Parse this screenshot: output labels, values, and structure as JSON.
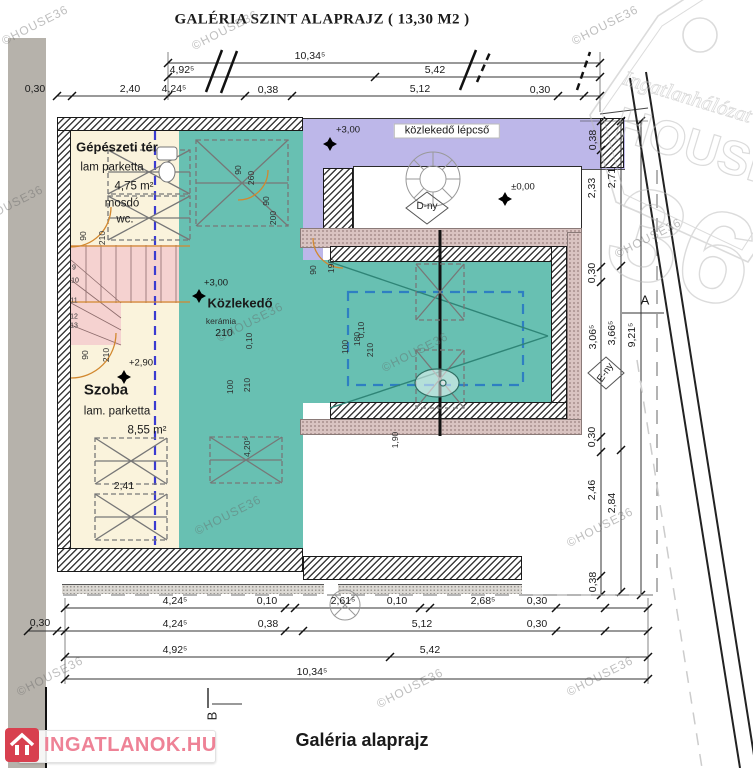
{
  "title": "GALÉRIA SZINT ALAPRAJZ ( 13,30 M2 )",
  "footer_title": "Galéria alaprajz",
  "watermark_text": "©HOUSE36",
  "brand_logo": {
    "text": "INGATLANOK.HU"
  },
  "house36_logo": {
    "top": "Ingatlanhálózat",
    "mid": "HOUSE",
    "num": "36"
  },
  "annotations": [
    {
      "name": "page-title",
      "cls": "t-title",
      "items": [
        {
          "t": "GALÉRIA SZINT ALAPRAJZ ( 13,30 M2 )",
          "x": 322,
          "y": 20
        }
      ]
    },
    {
      "name": "footer-title",
      "cls": "t-sub",
      "items": [
        {
          "t": "Galéria alaprajz",
          "x": 362,
          "y": 740
        }
      ]
    },
    {
      "name": "room-label",
      "cls": "t-room",
      "items": [
        {
          "t": "Gépészeti tér",
          "x": 117,
          "y": 147
        },
        {
          "t": "Közlekedő",
          "x": 240,
          "y": 303
        }
      ]
    },
    {
      "name": "room-label-large",
      "cls": "t-room-lg",
      "items": [
        {
          "t": "Szoba",
          "x": 106,
          "y": 390
        }
      ]
    },
    {
      "name": "room-subtext",
      "cls": "t-txt",
      "items": [
        {
          "t": "lam parketta",
          "x": 112,
          "y": 168
        },
        {
          "t": "4,75 m²",
          "x": 134,
          "y": 187
        },
        {
          "t": "mosdó",
          "x": 122,
          "y": 204
        },
        {
          "t": "wc.",
          "x": 125,
          "y": 220
        },
        {
          "t": "lam. parketta",
          "x": 117,
          "y": 412
        },
        {
          "t": "8,55 m²",
          "x": 147,
          "y": 431
        }
      ]
    },
    {
      "name": "room-subtext-small",
      "cls": "t-small",
      "items": [
        {
          "t": "kerámia",
          "x": 221,
          "y": 321
        }
      ]
    },
    {
      "name": "stair-corridor-label",
      "cls": "t-box",
      "items": [
        {
          "t": "közlekedő lépcső",
          "x": 447,
          "y": 131
        }
      ]
    },
    {
      "name": "level-mark",
      "cls": "t-lvl",
      "items": [
        {
          "t": "+3,00",
          "x": 348,
          "y": 130
        },
        {
          "t": "+3,00",
          "x": 216,
          "y": 283
        },
        {
          "t": "±0,00",
          "x": 523,
          "y": 187
        },
        {
          "t": "+2,90",
          "x": 141,
          "y": 363
        }
      ]
    },
    {
      "name": "orientation-mark",
      "cls": "t-marker",
      "items": [
        {
          "t": "D-ny",
          "x": 427,
          "y": 207
        },
        {
          "t": "E-ny",
          "x": 606,
          "y": 373,
          "r": -55
        }
      ]
    },
    {
      "name": "section-mark",
      "cls": "t-sec",
      "items": [
        {
          "t": "A",
          "x": 645,
          "y": 300
        },
        {
          "t": "B",
          "x": 212,
          "y": 716,
          "r": -90
        }
      ]
    },
    {
      "name": "dim-top",
      "cls": "t-dim",
      "items": [
        {
          "t": "10,34⁵",
          "x": 310,
          "y": 56
        },
        {
          "t": "4,92⁵",
          "x": 182,
          "y": 70
        },
        {
          "t": "5,42",
          "x": 435,
          "y": 70
        },
        {
          "t": "0,30",
          "x": 35,
          "y": 89
        },
        {
          "t": "2,40",
          "x": 130,
          "y": 89
        },
        {
          "t": "4,24⁵",
          "x": 174,
          "y": 89
        },
        {
          "t": "0,38",
          "x": 268,
          "y": 90
        },
        {
          "t": "5,12",
          "x": 420,
          "y": 89
        },
        {
          "t": "0,30",
          "x": 540,
          "y": 90
        }
      ]
    },
    {
      "name": "dim-bottom",
      "cls": "t-dim",
      "items": [
        {
          "t": "4,24⁵",
          "x": 175,
          "y": 601
        },
        {
          "t": "0,10",
          "x": 267,
          "y": 601
        },
        {
          "t": "2,61⁵",
          "x": 343,
          "y": 601
        },
        {
          "t": "0,10",
          "x": 397,
          "y": 601
        },
        {
          "t": "2,68⁵",
          "x": 483,
          "y": 601
        },
        {
          "t": "0,30",
          "x": 537,
          "y": 601
        },
        {
          "t": "0,30",
          "x": 40,
          "y": 623
        },
        {
          "t": "4,24⁵",
          "x": 175,
          "y": 624
        },
        {
          "t": "0,38",
          "x": 268,
          "y": 624
        },
        {
          "t": "5,12",
          "x": 422,
          "y": 624
        },
        {
          "t": "0,30",
          "x": 537,
          "y": 624
        },
        {
          "t": "4,92⁵",
          "x": 175,
          "y": 650
        },
        {
          "t": "5,42",
          "x": 430,
          "y": 650
        },
        {
          "t": "10,34⁵",
          "x": 312,
          "y": 672
        }
      ]
    },
    {
      "name": "dim-right",
      "cls": "t-dim",
      "r": -90,
      "items": [
        {
          "t": "0,38",
          "x": 593,
          "y": 140
        },
        {
          "t": "2,33",
          "x": 592,
          "y": 188
        },
        {
          "t": "0,30",
          "x": 592,
          "y": 273
        },
        {
          "t": "3,06⁵",
          "x": 593,
          "y": 337
        },
        {
          "t": "0,30",
          "x": 592,
          "y": 437
        },
        {
          "t": "2,46",
          "x": 592,
          "y": 490
        },
        {
          "t": "0,38",
          "x": 593,
          "y": 582
        },
        {
          "t": "2,71",
          "x": 612,
          "y": 178
        },
        {
          "t": "3,66⁵",
          "x": 612,
          "y": 333
        },
        {
          "t": "2,84",
          "x": 612,
          "y": 503
        },
        {
          "t": "9,21⁵",
          "x": 632,
          "y": 335
        }
      ]
    },
    {
      "name": "dim-door",
      "cls": "t-small",
      "r": -90,
      "items": [
        {
          "t": "90",
          "x": 83,
          "y": 236
        },
        {
          "t": "210",
          "x": 102,
          "y": 238
        },
        {
          "t": "90",
          "x": 238,
          "y": 170
        },
        {
          "t": "260",
          "x": 251,
          "y": 178
        },
        {
          "t": "90",
          "x": 266,
          "y": 201
        },
        {
          "t": "200",
          "x": 273,
          "y": 218
        },
        {
          "t": "90",
          "x": 85,
          "y": 355
        },
        {
          "t": "210",
          "x": 106,
          "y": 355
        },
        {
          "t": "100",
          "x": 230,
          "y": 387
        },
        {
          "t": "210",
          "x": 247,
          "y": 385
        },
        {
          "t": "0,10",
          "x": 249,
          "y": 341
        },
        {
          "t": "90",
          "x": 313,
          "y": 270
        },
        {
          "t": "190",
          "x": 331,
          "y": 266
        },
        {
          "t": "0,10",
          "x": 361,
          "y": 330
        },
        {
          "t": "100",
          "x": 345,
          "y": 347
        },
        {
          "t": "180",
          "x": 357,
          "y": 339
        },
        {
          "t": "210",
          "x": 370,
          "y": 350
        },
        {
          "t": "1,90",
          "x": 395,
          "y": 440
        },
        {
          "t": "4,20⁵",
          "x": 247,
          "y": 447
        }
      ]
    },
    {
      "name": "dim-inline",
      "cls": "t-dim",
      "items": [
        {
          "t": "2,41",
          "x": 124,
          "y": 486
        },
        {
          "t": "210",
          "x": 224,
          "y": 333
        }
      ]
    },
    {
      "name": "stair-step-number",
      "cls": "t-tiny",
      "items": [
        {
          "t": "9",
          "x": 74,
          "y": 268
        },
        {
          "t": "10",
          "x": 75,
          "y": 281
        },
        {
          "t": "11",
          "x": 74,
          "y": 301
        },
        {
          "t": "12",
          "x": 74,
          "y": 317
        },
        {
          "t": "13",
          "x": 74,
          "y": 326
        }
      ]
    }
  ],
  "watermarks": {
    "positions": [
      {
        "x": 35,
        "y": 25
      },
      {
        "x": 225,
        "y": 30
      },
      {
        "x": 605,
        "y": 25
      },
      {
        "x": 10,
        "y": 205
      },
      {
        "x": 648,
        "y": 238
      },
      {
        "x": 250,
        "y": 322
      },
      {
        "x": 415,
        "y": 352
      },
      {
        "x": 228,
        "y": 515
      },
      {
        "x": 600,
        "y": 527
      },
      {
        "x": 50,
        "y": 676
      },
      {
        "x": 410,
        "y": 688
      },
      {
        "x": 600,
        "y": 676
      }
    ]
  }
}
